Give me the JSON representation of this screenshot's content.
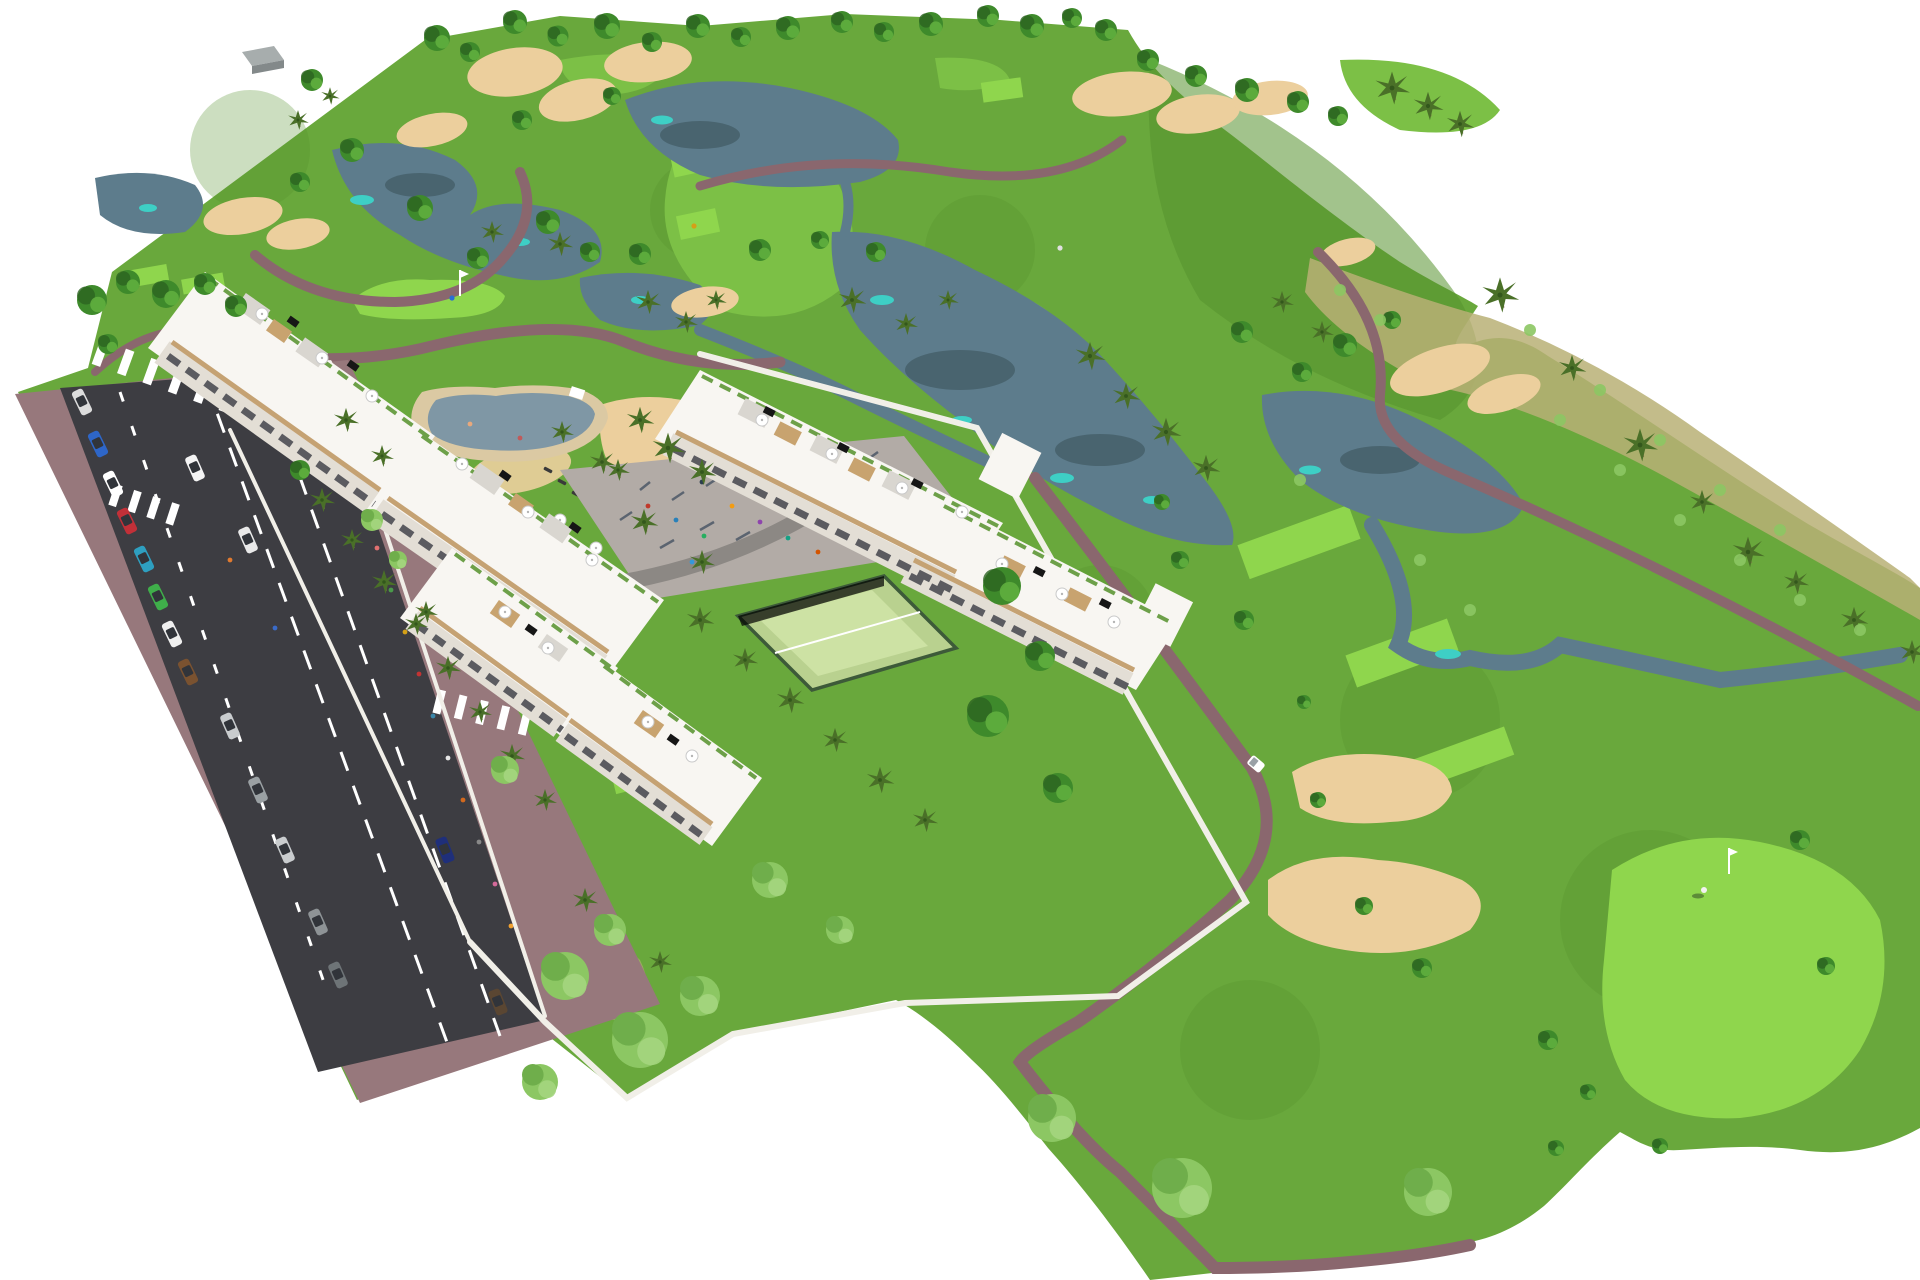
{
  "meta": {
    "title": "Aerial rendering of golf resort apartment complex",
    "description": "Computer-generated bird's-eye rendering of a residential development: three white terraced apartment blocks with rooftop terraces beside a road with parked cars, a lagoon pool with parasols, an outdoor gym playground, a padel court, all surrounded by a golf course with lakes, sand bunkers, winding cart paths, palm trees and a putting green with flag."
  },
  "palette": {
    "bg": "#ffffff",
    "grass": "#69a83c",
    "grassDark": "#55912e",
    "fairway": "#7cc046",
    "green": "#8fd64d",
    "rough": "#b9b075",
    "sand": "#eccf9d",
    "water": "#5d7c8c",
    "waterTeal": "#3ecfc5",
    "waterDark": "#49646f",
    "path": "#8a676e",
    "road": "#3d3d42",
    "roadLine": "#ffffff",
    "sidewalk": "#97787c",
    "wall": "#f1efe8",
    "bld": "#f8f6f2",
    "bldShade": "#e3ded5",
    "accent": "#c5a273",
    "slit": "#5b5b60",
    "roofGravel": "#d9d6d0",
    "deck": "#c8a36f",
    "solar": "#161616",
    "planter": "#6da049",
    "treeDark": "#2c6321",
    "tree": "#3e8a2b",
    "treeLight": "#8cc763",
    "palm": "#4a7028",
    "trunk": "#8a6f50",
    "pool": "#7f97a5",
    "poolDeck": "#dbc9a3",
    "padel": "#b9d18f",
    "fence": "#3d5a39",
    "paving": "#b2aba6",
    "pavingDark": "#8c8884"
  },
  "scene": {
    "setting": "golf-resort-masterplan-render",
    "counts": {
      "apartment_blocks": 3,
      "pools": 1,
      "padel_courts": 1,
      "playgrounds": 1,
      "golf_flags": 2,
      "golf_carts": 1,
      "crosswalks": 3,
      "parked_cars": 13
    },
    "features": [
      "golf course with lakes and sand bunkers",
      "white terraced apartment buildings with roof parasols and solar panels",
      "lagoon swimming pool with sun loungers and white parasols",
      "outdoor gym and playground plaza",
      "padel tennis court",
      "two-lane road with parking, crosswalks and cars",
      "mauve cart paths, palm trees, putting green with flagstick and golfer"
    ]
  }
}
